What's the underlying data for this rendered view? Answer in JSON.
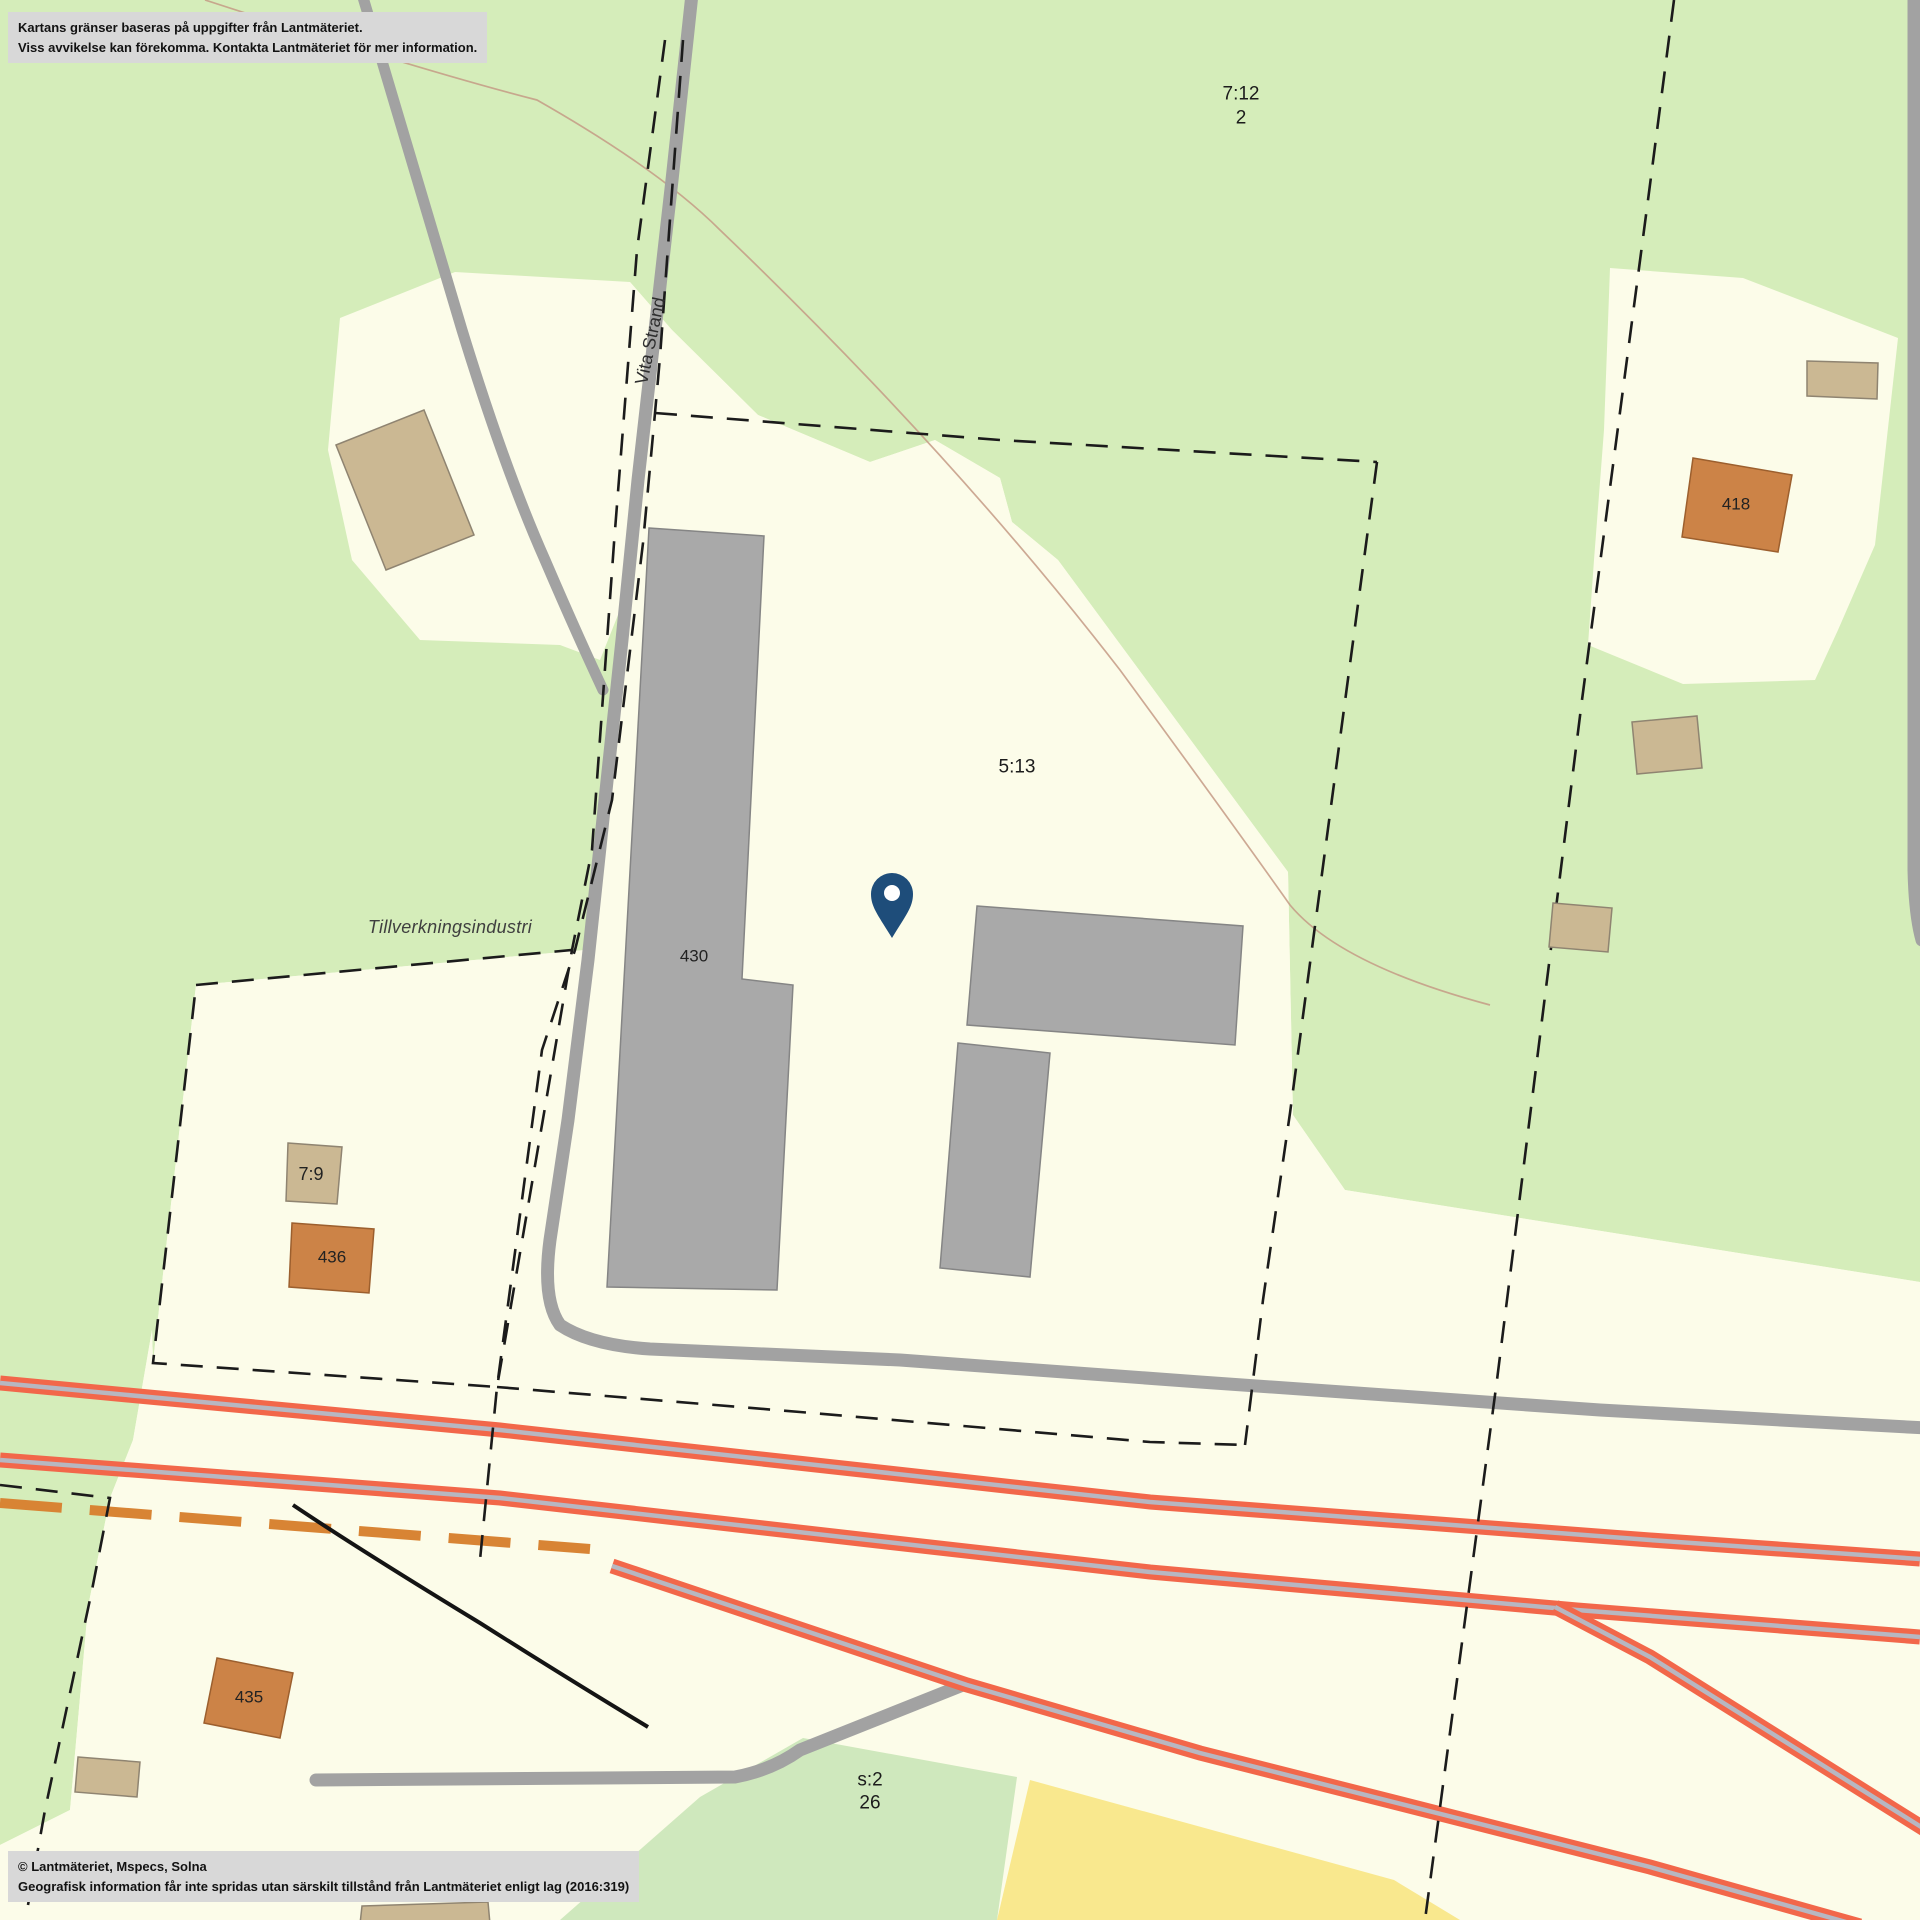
{
  "colors": {
    "green": "#d5edba",
    "green2": "#cfe8bd",
    "cream": "#fcfce9",
    "yellow": "#f9e88e",
    "road": "#a2a2a2",
    "rail": "#f2674a",
    "railcore": "#b7b7c1",
    "bldg": "#a9a9a9",
    "bldgline": "#858585",
    "tan": "#cbb893",
    "tanline": "#8f8471",
    "orangebldg": "#cc8347",
    "orangebldgline": "#9c5f2e",
    "orangedash": "#d88434",
    "dashline": "#1b1b1b",
    "brown": "#c49a85",
    "notice": "#d8d8d8",
    "pin": "#1e4d7a"
  },
  "notices": {
    "top": {
      "line1": "Kartans gränser baseras på uppgifter från Lantmäteriet.",
      "line2": "Viss avvikelse kan förekomma. Kontakta Lantmäteriet för mer information."
    },
    "bottom": {
      "line1": "© Lantmäteriet, Mspecs, Solna",
      "line2": "Geografisk information får inte spridas utan särskilt tillstånd från Lantmäteriet enligt lag (2016:319)"
    }
  },
  "labels": {
    "parcel_7_12": "7:12",
    "parcel_7_12_sub": "2",
    "parcel_5_13": "5:13",
    "road_name": "Vita Strand",
    "industry": "Tillverkningsindustri",
    "parcel_7_9": "7:9",
    "parcel_s2": "s:2",
    "parcel_s2_sub": "26",
    "building_430": "430",
    "building_436": "436",
    "building_435": "435",
    "building_418": "418"
  }
}
